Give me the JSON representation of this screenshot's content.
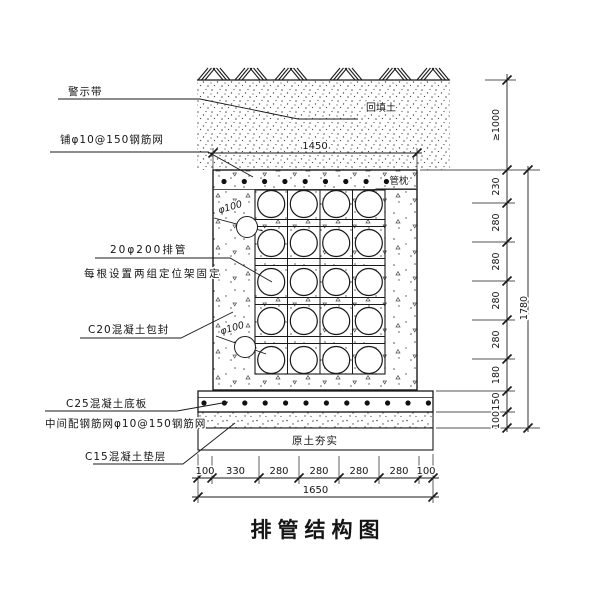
{
  "title": "排管结构图",
  "labels": {
    "warning_tape": "警示带",
    "top_mesh": "铺φ10@150钢筋网",
    "pipes_line1": "20φ200排管",
    "pipes_line2": "每根设置两组定位架固定",
    "encasement": "C20混凝土包封",
    "base_slab": "C25混凝土底板",
    "slab_mesh": "中间配钢筋网φ10@150钢筋网",
    "cushion": "C15混凝土垫层",
    "backfill": "回填土",
    "pipe_pillow": "管枕",
    "compacted_soil": "原土夯实",
    "small_pipe_1": "φ100",
    "small_pipe_2": "φ100"
  },
  "dimensions": {
    "top_width": "1450",
    "bottom_segments": [
      "100",
      "330",
      "280",
      "280",
      "280",
      "280",
      "100"
    ],
    "bottom_total": "1650",
    "right_cover": "≥1000",
    "right_segments": [
      "230",
      "280",
      "280",
      "280",
      "280",
      "180",
      "150",
      "100"
    ],
    "right_total": "1780"
  },
  "colors": {
    "line": "#1a1a1a",
    "background": "#ffffff"
  }
}
